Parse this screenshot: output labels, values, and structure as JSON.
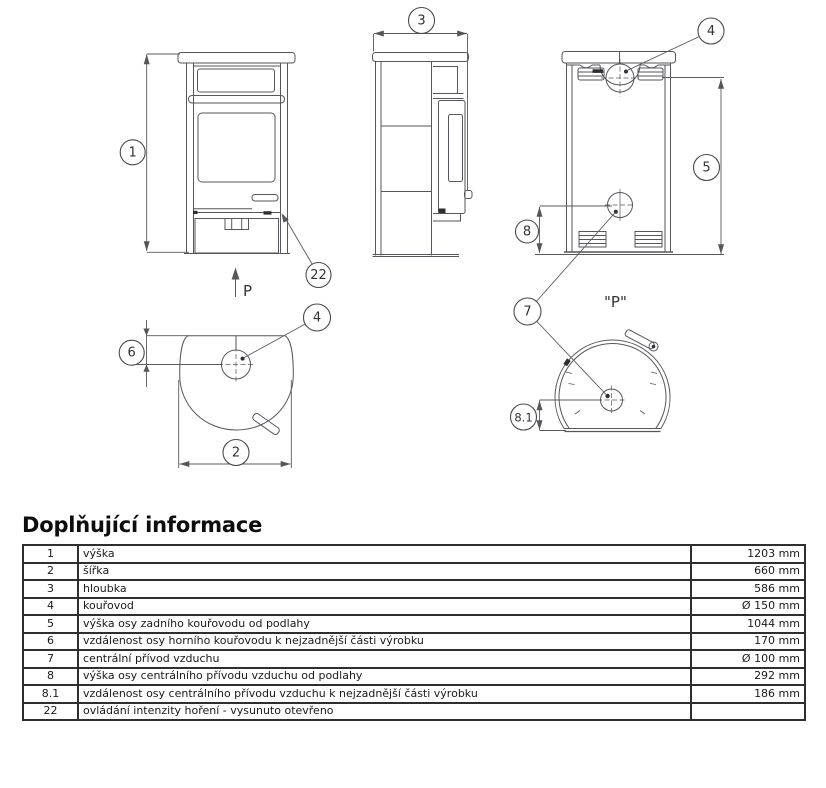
{
  "diagram": {
    "callouts": {
      "n1": "1",
      "n2": "2",
      "n3": "3",
      "n4": "4",
      "n5": "5",
      "n6": "6",
      "n7": "7",
      "n8": "8",
      "n8_1": "8.1",
      "n22": "22"
    },
    "front_direction_label": "P",
    "rear_view_label": "\"P\""
  },
  "info": {
    "title": "Doplňující informace",
    "rows": [
      {
        "num": "1",
        "desc": "výška",
        "value": "1203 mm"
      },
      {
        "num": "2",
        "desc": "šířka",
        "value": "660 mm"
      },
      {
        "num": "3",
        "desc": "hloubka",
        "value": "586 mm"
      },
      {
        "num": "4",
        "desc": "kouřovod",
        "value": "Ø 150 mm"
      },
      {
        "num": "5",
        "desc": "výška osy zadního kouřovodu od podlahy",
        "value": "1044 mm"
      },
      {
        "num": "6",
        "desc": "vzdálenost osy horního kouřovodu k nejzadnější části výrobku",
        "value": "170 mm"
      },
      {
        "num": "7",
        "desc": "centrální přívod vzduchu",
        "value": "Ø 100 mm"
      },
      {
        "num": "8",
        "desc": "výška osy centrálního přívodu vzduchu od podlahy",
        "value": "292 mm"
      },
      {
        "num": "8.1",
        "desc": "vzdálenost osy centrálního přívodu vzduchu k nejzadnější části výrobku",
        "value": "186 mm"
      },
      {
        "num": "22",
        "desc": "ovládání intenzity hoření - vysunuto otevřeno",
        "value": ""
      }
    ]
  }
}
